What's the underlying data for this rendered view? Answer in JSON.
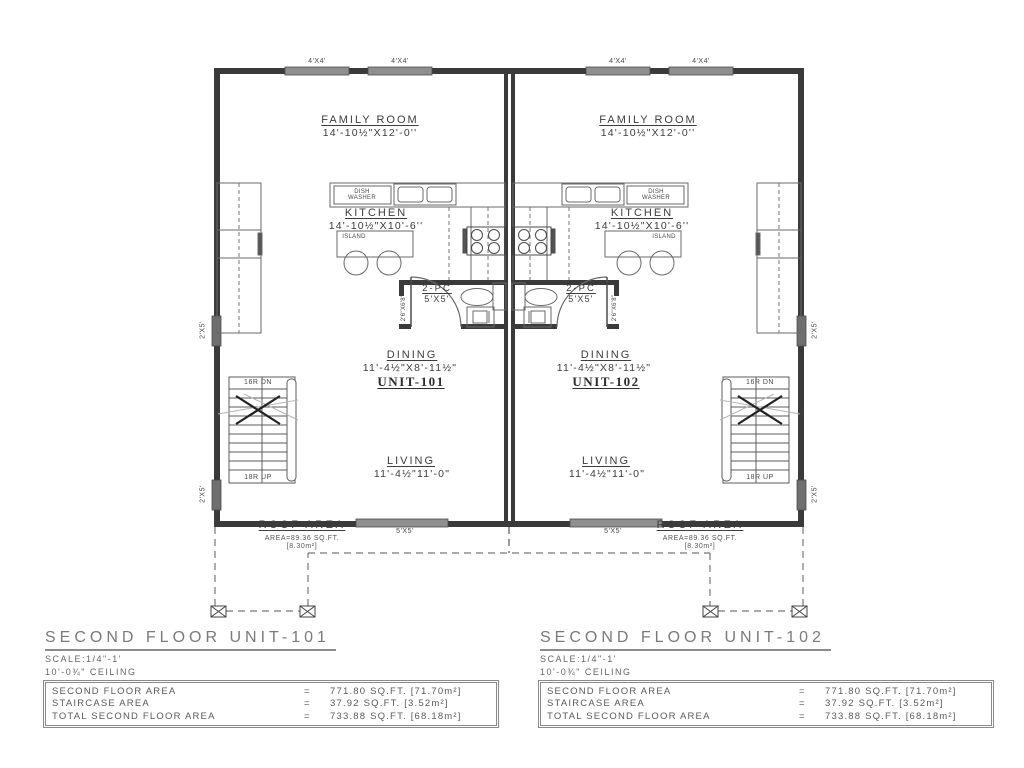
{
  "plan": {
    "window_top_label": "4'X4'",
    "window_side_label": "2'X5'",
    "window_bottom_label": "5'X5'",
    "family_room": {
      "name": "FAMILY ROOM",
      "dims": "14'-10½\"X12'-0''"
    },
    "kitchen": {
      "name": "KITCHEN",
      "dims": "14'-10½\"X10'-6''"
    },
    "island_label": "ISLAND",
    "dishwasher_line1": "DISH",
    "dishwasher_line2": "WASHER",
    "bath": {
      "name": "2-PC",
      "dims": "5'X5'",
      "door_label": "2'6\"X6'8\""
    },
    "dining": {
      "name": "DINING",
      "dims": "11'-4½\"X8'-11½\""
    },
    "living": {
      "name": "LIVING",
      "dims": "11'-4½\"11'-0\""
    },
    "stairs": {
      "down": "16R DN",
      "up": "18R UP"
    },
    "roof": {
      "title": "ROOF AREA",
      "area": "AREA=89.36 SQ.FT.",
      "metric": "[8.30m²]"
    },
    "unit_101": "UNIT-101",
    "unit_102": "UNIT-102"
  },
  "title_blocks": [
    {
      "heading": "SECOND FLOOR UNIT-101",
      "scale": "SCALE:1/4\"-1'",
      "ceiling": "10'-0¾\" CEILING",
      "rows": [
        {
          "label": "SECOND FLOOR AREA",
          "eq": "=",
          "value": "771.80 SQ.FT. [71.70m²]"
        },
        {
          "label": "STAIRCASE AREA",
          "eq": "=",
          "value": "37.92 SQ.FT. [3.52m²]"
        },
        {
          "label": "TOTAL SECOND FLOOR AREA",
          "eq": "=",
          "value": "733.88 SQ.FT. [68.18m²]"
        }
      ]
    },
    {
      "heading": "SECOND FLOOR UNIT-102",
      "scale": "SCALE:1/4\"-1'",
      "ceiling": "10'-0¾\" CEILING",
      "rows": [
        {
          "label": "SECOND FLOOR AREA",
          "eq": "=",
          "value": "771.80 SQ.FT. [71.70m²]"
        },
        {
          "label": "STAIRCASE AREA",
          "eq": "=",
          "value": "37.92 SQ.FT. [3.52m²]"
        },
        {
          "label": "TOTAL SECOND FLOOR AREA",
          "eq": "=",
          "value": "733.88 SQ.FT. [68.18m²]"
        }
      ]
    }
  ]
}
